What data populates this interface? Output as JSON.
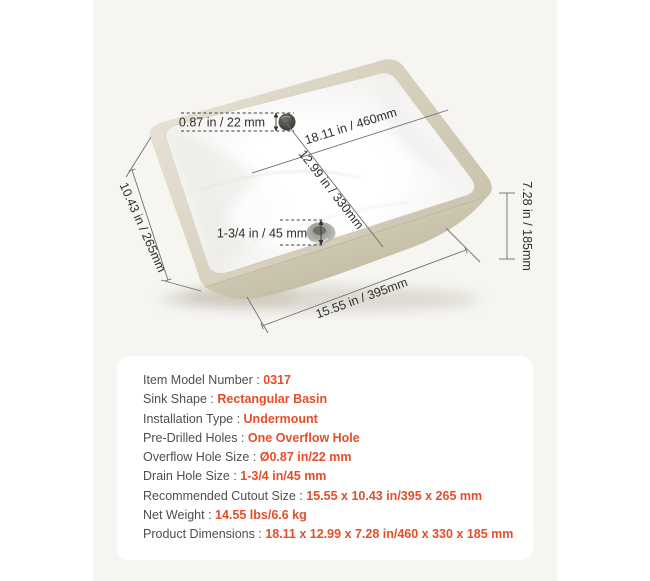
{
  "illustration": {
    "dims": {
      "overflow_hole": "0.87 in / 22 mm",
      "basin_length": "18.11 in / 460mm",
      "basin_width": "12.99 in / 330mm",
      "side_width": "10.43 in / 265mm",
      "drain_hole": "1-3/4 in / 45 mm",
      "height": "7.28 in / 185mm",
      "bottom_length": "15.55 in / 395mm"
    }
  },
  "specs": {
    "separator": " : ",
    "rows": [
      {
        "label": "Item Model Number",
        "value": "0317"
      },
      {
        "label": "Sink Shape",
        "value": "Rectangular Basin"
      },
      {
        "label": "Installation Type",
        "value": "Undermount"
      },
      {
        "label": "Pre-Drilled Holes",
        "value": "One Overflow Hole"
      },
      {
        "label": "Overflow Hole Size",
        "value": "Ø0.87 in/22 mm"
      },
      {
        "label": "Drain Hole Size",
        "value": "1-3/4 in/45 mm"
      },
      {
        "label": "Recommended Cutout Size",
        "value": "15.55 x 10.43 in/395 x 265 mm"
      },
      {
        "label": "Net Weight",
        "value": "14.55 lbs/6.6 kg"
      },
      {
        "label": "Product Dimensions",
        "value": "18.11 x 12.99 x 7.28 in/460 x 330 x 185 mm"
      }
    ]
  },
  "colors": {
    "accent": "#e64d28",
    "content_background": "#f6f5f2",
    "card_background": "#ffffff",
    "sink_rim": "#d8d2c0",
    "dimension_line": "#6f6f6f"
  }
}
